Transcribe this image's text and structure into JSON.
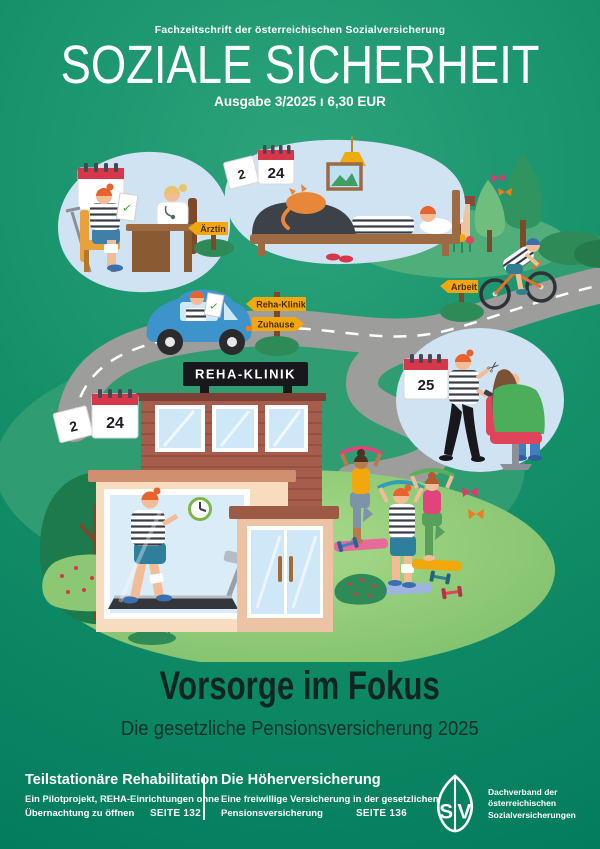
{
  "header": {
    "tagline": "Fachzeitschrift der österreichischen Sozialversicherung",
    "title": "SOZIALE SICHERHEIT",
    "issue_line": "Ausgabe 3/2025 ı 6,30 EUR"
  },
  "illustration": {
    "road_signs": {
      "doctor": "Ärztin",
      "clinic": "Reha-Klinik",
      "home": "Zuhause",
      "work": "Arbeit"
    },
    "clinic_sign": "REHA-KLINIK",
    "calendars": {
      "doctor_visit_day": "1",
      "home_rest_loose_page": "2",
      "home_rest_day": "24",
      "clinic_loose_page": "2",
      "clinic_day": "24",
      "hairdresser_day": "25"
    }
  },
  "feature": {
    "title": "Vorsorge im Fokus",
    "subtitle": "Die gesetzliche Pensionsversicherung 2025"
  },
  "footer": {
    "article_left": {
      "title": "Teilstationäre Rehabilitation",
      "line1": "Ein Pilotprojekt, REHA-Einrichtungen ohne",
      "line2": "Übernachtung zu öffnen",
      "page_ref": "SEITE 132"
    },
    "article_right": {
      "title": "Die Höherversicherung",
      "line1": "Eine freiwillige Versicherung in der gesetzlichen",
      "line2": "Pensionsversicherung",
      "page_ref": "SEITE 136"
    },
    "logo": {
      "letter_s": "S",
      "letter_v": "V",
      "caption_line1": "Dachverband der",
      "caption_line2": "österreichischen",
      "caption_line3": "Sozialversicherungen"
    }
  },
  "colors": {
    "background_center": "#2da37b",
    "background_edge": "#00795a",
    "scene_bubble_blue": "#cfe3f2",
    "road_gray": "#9d9d9b",
    "sign_yellow": "#f2a70c",
    "calendar_red": "#d6374a",
    "brick_red": "#a65d4b",
    "lawn_green": "#a8d888",
    "title_dark": "#0f2620",
    "text_white": "#ffffff"
  }
}
